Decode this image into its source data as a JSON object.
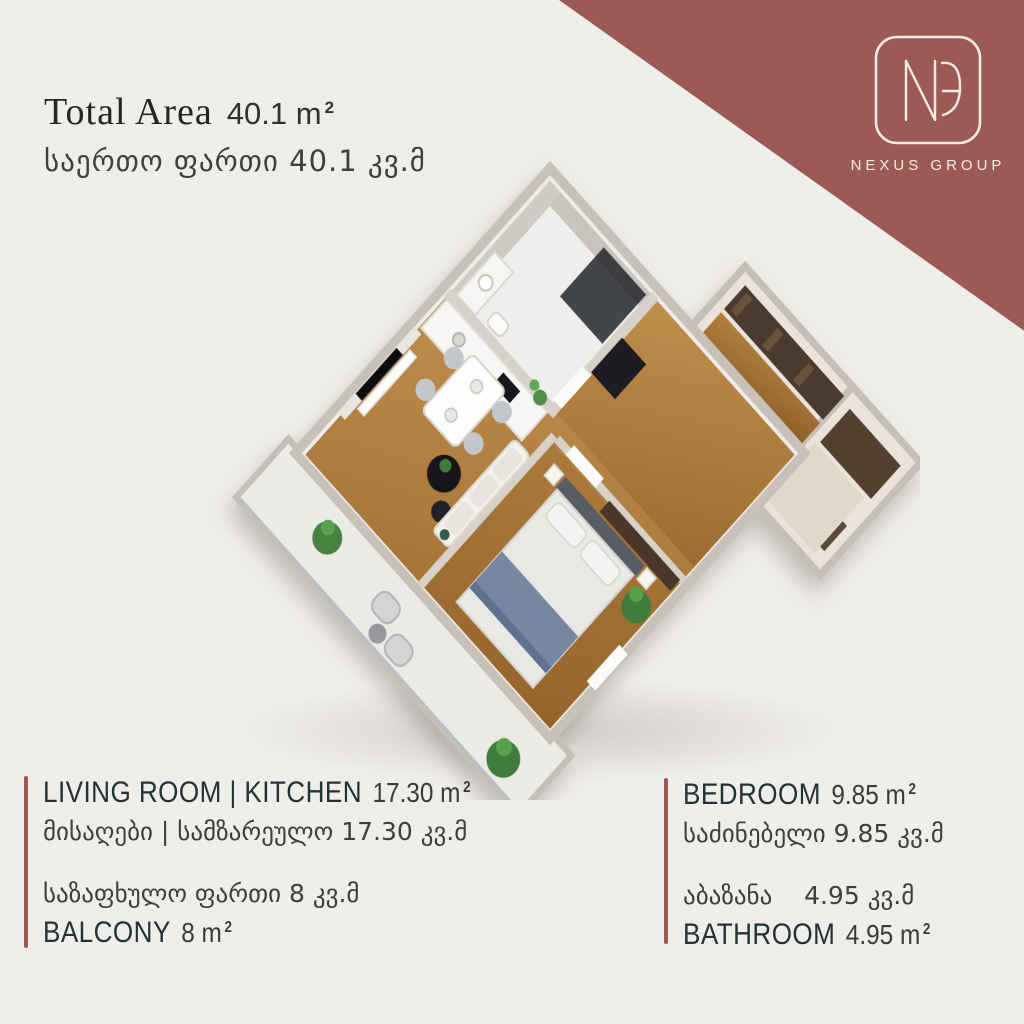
{
  "colors": {
    "background": "#f1efeb",
    "accent_maroon": "#9c5a54",
    "text_dark_teal": "#223432",
    "text_near_black": "#262523",
    "logo_text": "#f4eae6",
    "wood_floor": "#b07c3e"
  },
  "header": {
    "title_en": "Total Area",
    "value_en": "40.1 m",
    "line_ka": "საერთო ფართი 40.1 კვ.მ"
  },
  "logo": {
    "monogram": "NG",
    "company": "NEXUS GROUP"
  },
  "panels": {
    "sup": "2",
    "bottom_left": {
      "room1_label": "LIVING ROOM | KITCHEN",
      "room1_value": "17.30 m",
      "room1_ka": "მისაღები | სამზარეულო 17.30 კვ.მ",
      "room2_ka": "საზაფხულო ფართი 8 კვ.მ",
      "room2_label": "BALCONY",
      "room2_value": "8 m"
    },
    "bottom_right": {
      "room1_label": "BEDROOM",
      "room1_value": "9.85 m",
      "room1_ka": "საძინებელი 9.85 კვ.მ",
      "room2_ka": "აბაზანა    4.95 კვ.მ",
      "room2_label": "BATHROOM",
      "room2_value": "4.95 m"
    }
  }
}
